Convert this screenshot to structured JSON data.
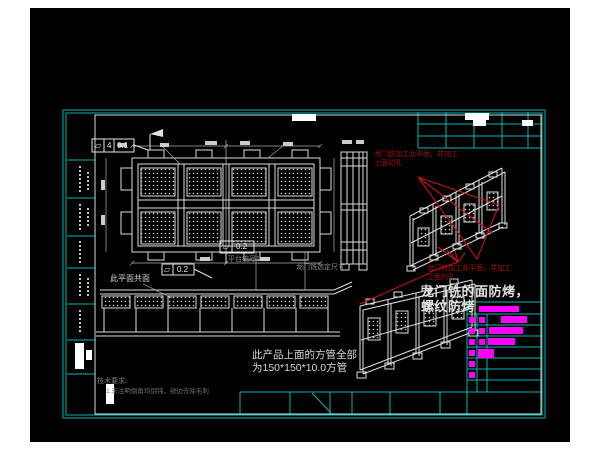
{
  "colors": {
    "background": "#000000",
    "frame_teal": "#00b6b6",
    "line_white": "#d8d8d8",
    "annotation_red": "#c01616",
    "red_text": "#a61111",
    "magenta": "#ff00ff",
    "dim_gray": "#8a8a8a"
  },
  "tolerances": {
    "top_frame": {
      "symbol": "⏥",
      "zones": "4",
      "value": "0.1"
    },
    "mid_frame": {
      "symbol": "⏥",
      "value": "0.2"
    },
    "bottom_frame": {
      "symbol": "⏥",
      "value": "0.2"
    }
  },
  "notes": {
    "coplanar": "此平面共面",
    "platform_no": "平台编号1",
    "gantry_size": "龙门铣选定尺寸",
    "red_top_line1": "龙门铣加工此平面，并加工",
    "red_top_line2": "上面的孔",
    "red_bottom_line1": "龙门铣加工此平面，并加工",
    "red_bottom_line2": "上面的孔",
    "face_note_line1": "龙门铣的面防烤，",
    "face_note_line2": "螺纹防烤",
    "tube_note_line1": "此产品上面的方管全部",
    "tube_note_line2": "为150*150*10.0方管",
    "tech_title": "技术要求:",
    "tech_item1": "1.未注明倒角均倒钝，锐边去除毛刺"
  }
}
